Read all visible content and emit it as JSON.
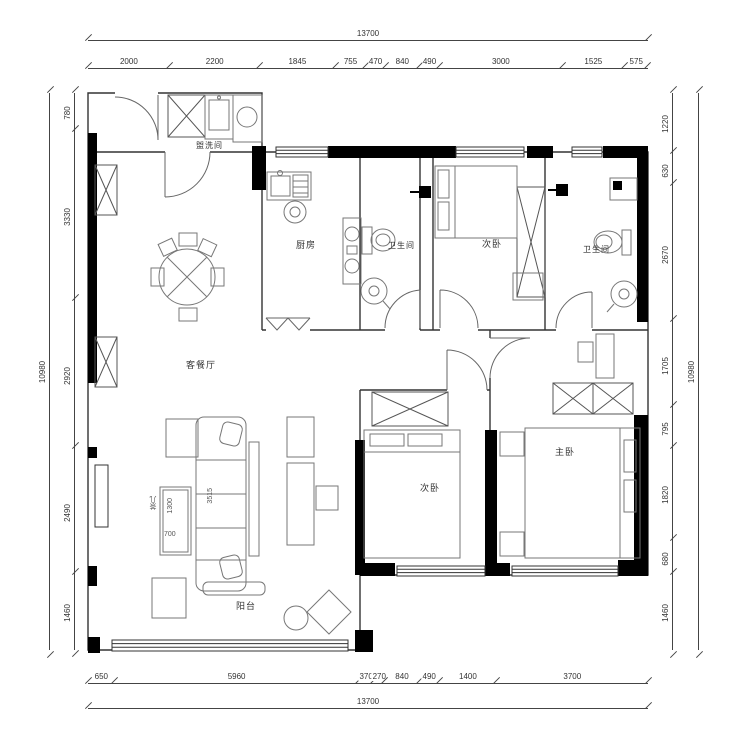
{
  "plan": {
    "rooms": {
      "utility": "盥洗间",
      "kitchen": "厨房",
      "bath1": "卫生间",
      "bedroom_top": "次卧",
      "bath2": "卫生间",
      "living": "客餐厅",
      "bedroom_bottom": "次卧",
      "master": "主卧",
      "balcony": "阳台"
    },
    "furniture_labels": {
      "sofa_length": "3515",
      "table_name": "茶几",
      "table_length": "1300",
      "table_width": "700"
    }
  },
  "dimensions": {
    "top_total": [
      13700
    ],
    "top": [
      2000,
      2200,
      1845,
      755,
      470,
      840,
      490,
      3000,
      1525,
      575
    ],
    "bottom": [
      650,
      5960,
      370,
      270,
      840,
      490,
      1400,
      3700
    ],
    "bottom_total": [
      13700
    ],
    "left": [
      780,
      3330,
      2920,
      2490,
      1460
    ],
    "left_total": [
      10980
    ],
    "right": [
      1220,
      630,
      2670,
      1705,
      795,
      1820,
      680,
      1460
    ],
    "right_total": [
      10980
    ]
  }
}
